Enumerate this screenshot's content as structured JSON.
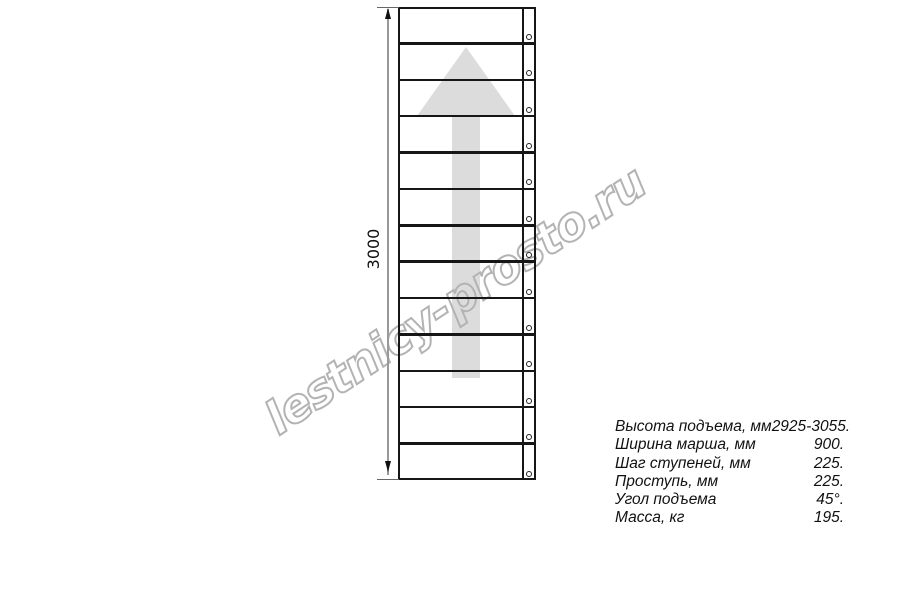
{
  "watermark": {
    "text": "lestnicy-prosto.ru",
    "stroke_color": "#b3b3b3"
  },
  "drawing": {
    "steps_count": 13,
    "arrow_color": "#dcdcdc",
    "line_color": "#161616"
  },
  "dimension": {
    "label": "3000"
  },
  "specs": {
    "rows": [
      {
        "label": "Высота подъема, мм",
        "value": "2925-3055."
      },
      {
        "label": "Ширина марша, мм",
        "value": "900."
      },
      {
        "label": "Шаг ступеней, мм",
        "value": "225."
      },
      {
        "label": "Проступь, мм",
        "value": "225."
      },
      {
        "label": "Угол подъема",
        "value": "45°."
      },
      {
        "label": "Масса, кг",
        "value": "195."
      }
    ]
  }
}
